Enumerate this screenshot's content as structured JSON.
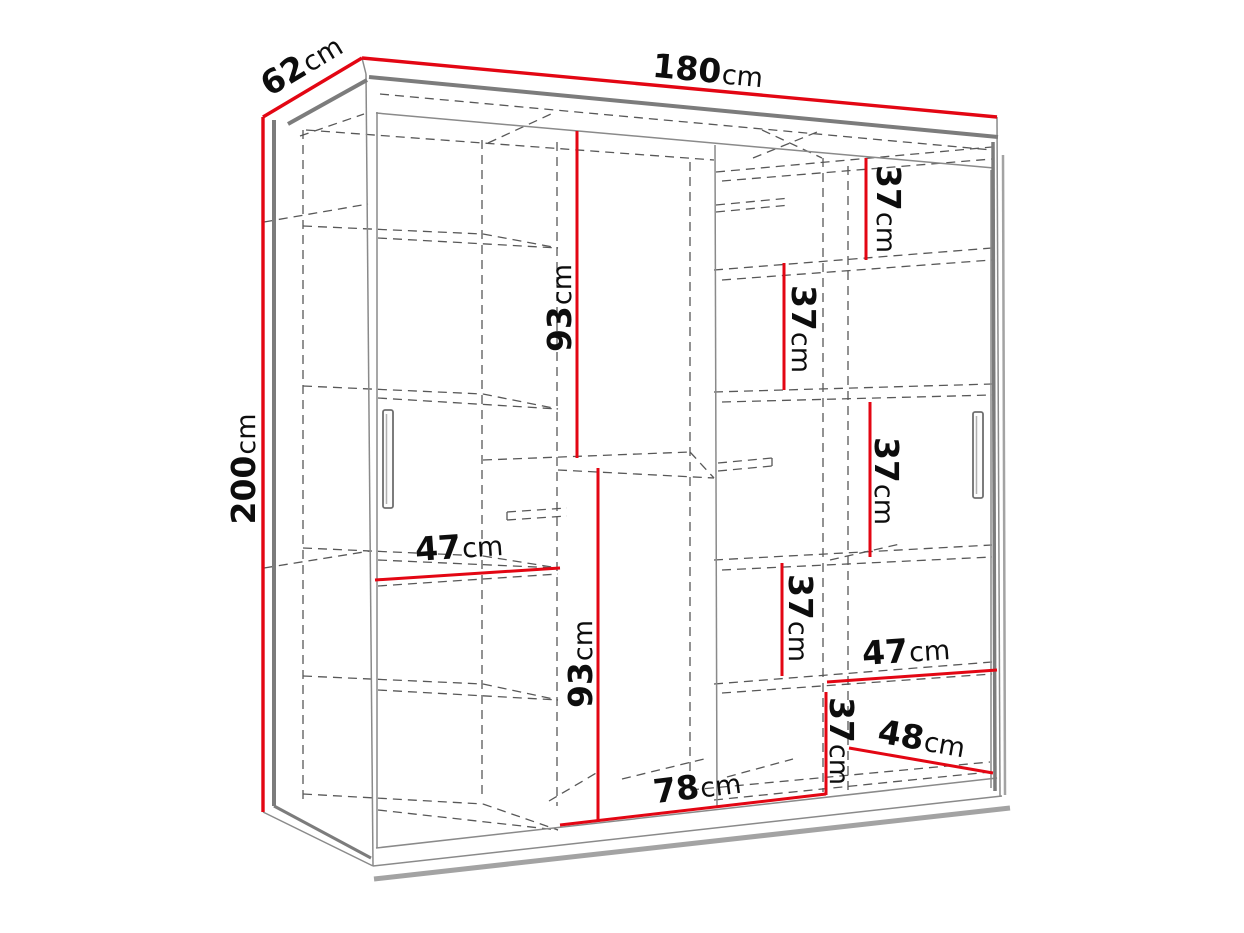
{
  "diagram_type": "wardrobe-dimension-drawing",
  "colors": {
    "dimension_line": "#e30613",
    "outline_gray": "#8a8a8a",
    "thick_edge_gray": "#7c7c7c",
    "dashed_interior_gray": "#585858",
    "label_text": "#0d0d0d",
    "background": "#ffffff"
  },
  "dimension_labels": [
    {
      "id": "depth",
      "num": "62",
      "unit": "cm"
    },
    {
      "id": "width",
      "num": "180",
      "unit": "cm"
    },
    {
      "id": "height",
      "num": "200",
      "unit": "cm"
    },
    {
      "id": "upper-hanging-space",
      "num": "93",
      "unit": "cm"
    },
    {
      "id": "lower-hanging-space",
      "num": "93",
      "unit": "cm"
    },
    {
      "id": "right-gap-1",
      "num": "37",
      "unit": "cm"
    },
    {
      "id": "right-gap-2",
      "num": "37",
      "unit": "cm"
    },
    {
      "id": "right-gap-3",
      "num": "37",
      "unit": "cm"
    },
    {
      "id": "right-gap-4",
      "num": "37",
      "unit": "cm"
    },
    {
      "id": "right-gap-5",
      "num": "37",
      "unit": "cm"
    },
    {
      "id": "left-shelf-width",
      "num": "47",
      "unit": "cm"
    },
    {
      "id": "right-shelf-width",
      "num": "47",
      "unit": "cm"
    },
    {
      "id": "bottom-right-width",
      "num": "48",
      "unit": "cm"
    },
    {
      "id": "bottom-middle-width",
      "num": "78",
      "unit": "cm"
    }
  ]
}
